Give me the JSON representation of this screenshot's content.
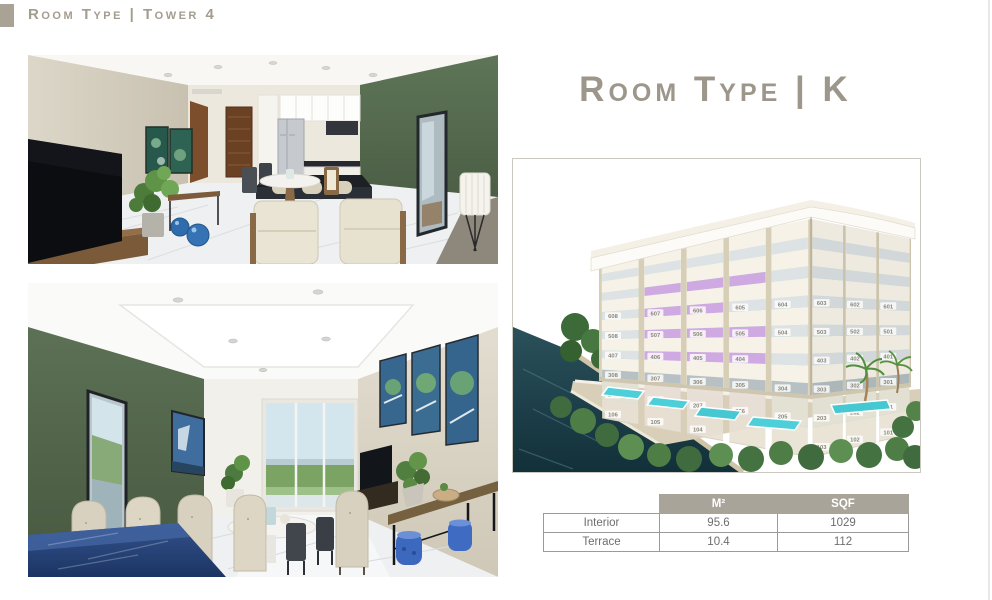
{
  "header": {
    "label": "Room Type | Tower 4"
  },
  "panel": {
    "title": "Room Type | K"
  },
  "area_table": {
    "columns": [
      "M²",
      "SQF"
    ],
    "rows": [
      {
        "label": "Interior",
        "m2": "95.6",
        "sqf": "1029"
      },
      {
        "label": "Terrace",
        "m2": "10.4",
        "sqf": "112"
      }
    ]
  },
  "building": {
    "floors_left": [
      [
        "608",
        "607",
        "606",
        "605",
        "604"
      ],
      [
        "508",
        "507",
        "506",
        "505",
        "504"
      ],
      [
        "407",
        "406",
        "405",
        "404",
        ""
      ],
      [
        "308",
        "307",
        "306",
        "305",
        "304"
      ],
      [
        "209",
        "208",
        "207",
        "206",
        "205"
      ],
      [
        "106",
        "105",
        "104",
        "",
        ""
      ]
    ],
    "floors_right": [
      [
        "603",
        "602",
        "601"
      ],
      [
        "503",
        "502",
        "501"
      ],
      [
        "403",
        "402",
        "401"
      ],
      [
        "303",
        "302",
        "301"
      ],
      [
        "203",
        "202",
        "201"
      ],
      [
        "103",
        "102",
        "101"
      ]
    ],
    "highlight_units": [
      "507",
      "506",
      "505",
      "406",
      "405",
      "307",
      "306",
      "305",
      "208",
      "207",
      "206"
    ]
  },
  "colors": {
    "accent_taupe": "#a9a49a",
    "highlight_purple": "#cfa9e2",
    "balcony_teal": "#a2d9d3",
    "pool_turquoise": "#4ccfd8",
    "water_dark": "#1f434d",
    "green_wall": "#5c7156"
  }
}
